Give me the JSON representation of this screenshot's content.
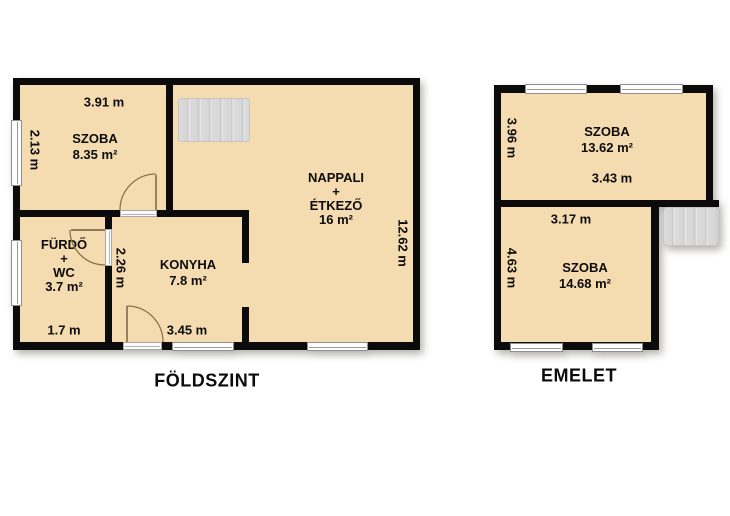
{
  "document_type": "floor-plan",
  "colors": {
    "wall": "#0b0b0b",
    "room_fill": "#f5dcb0",
    "window_fill": "#fdfdfd",
    "stairs_fill": "#dbdbdb",
    "door_arc": "#8c7449",
    "background": "#ffffff",
    "text": "#0c0c0c"
  },
  "ground_floor": {
    "title": "FÖLDSZINT",
    "rooms": {
      "szoba": {
        "name": "SZOBA",
        "area": "8.35 m²"
      },
      "furdo": {
        "name": "FÜRDŐ",
        "plus": "+",
        "subname": "WC",
        "area": "3.7 m²"
      },
      "konyha": {
        "name": "KONYHA",
        "area": "7.8 m²"
      },
      "nappali": {
        "name": "NAPPALI",
        "plus": "+",
        "subname": "ÉTKEZŐ",
        "area": "16 m²"
      }
    },
    "dimensions": {
      "szoba_width": "3.91 m",
      "szoba_depth": "2.13 m",
      "nappali_depth": "12.62 m",
      "konyha_depth": "2.26 m",
      "konyha_width": "3.45 m",
      "furdo_width": "1.7 m"
    }
  },
  "upper_floor": {
    "title": "EMELET",
    "rooms": {
      "szoba_top": {
        "name": "SZOBA",
        "area": "13.62 m²"
      },
      "szoba_bottom": {
        "name": "SZOBA",
        "area": "14.68 m²"
      }
    },
    "dimensions": {
      "szoba_top_depth": "3.96 m",
      "szoba_top_width": "3.43 m",
      "szoba_bottom_width": "3.17 m",
      "szoba_bottom_depth": "4.63 m"
    }
  }
}
